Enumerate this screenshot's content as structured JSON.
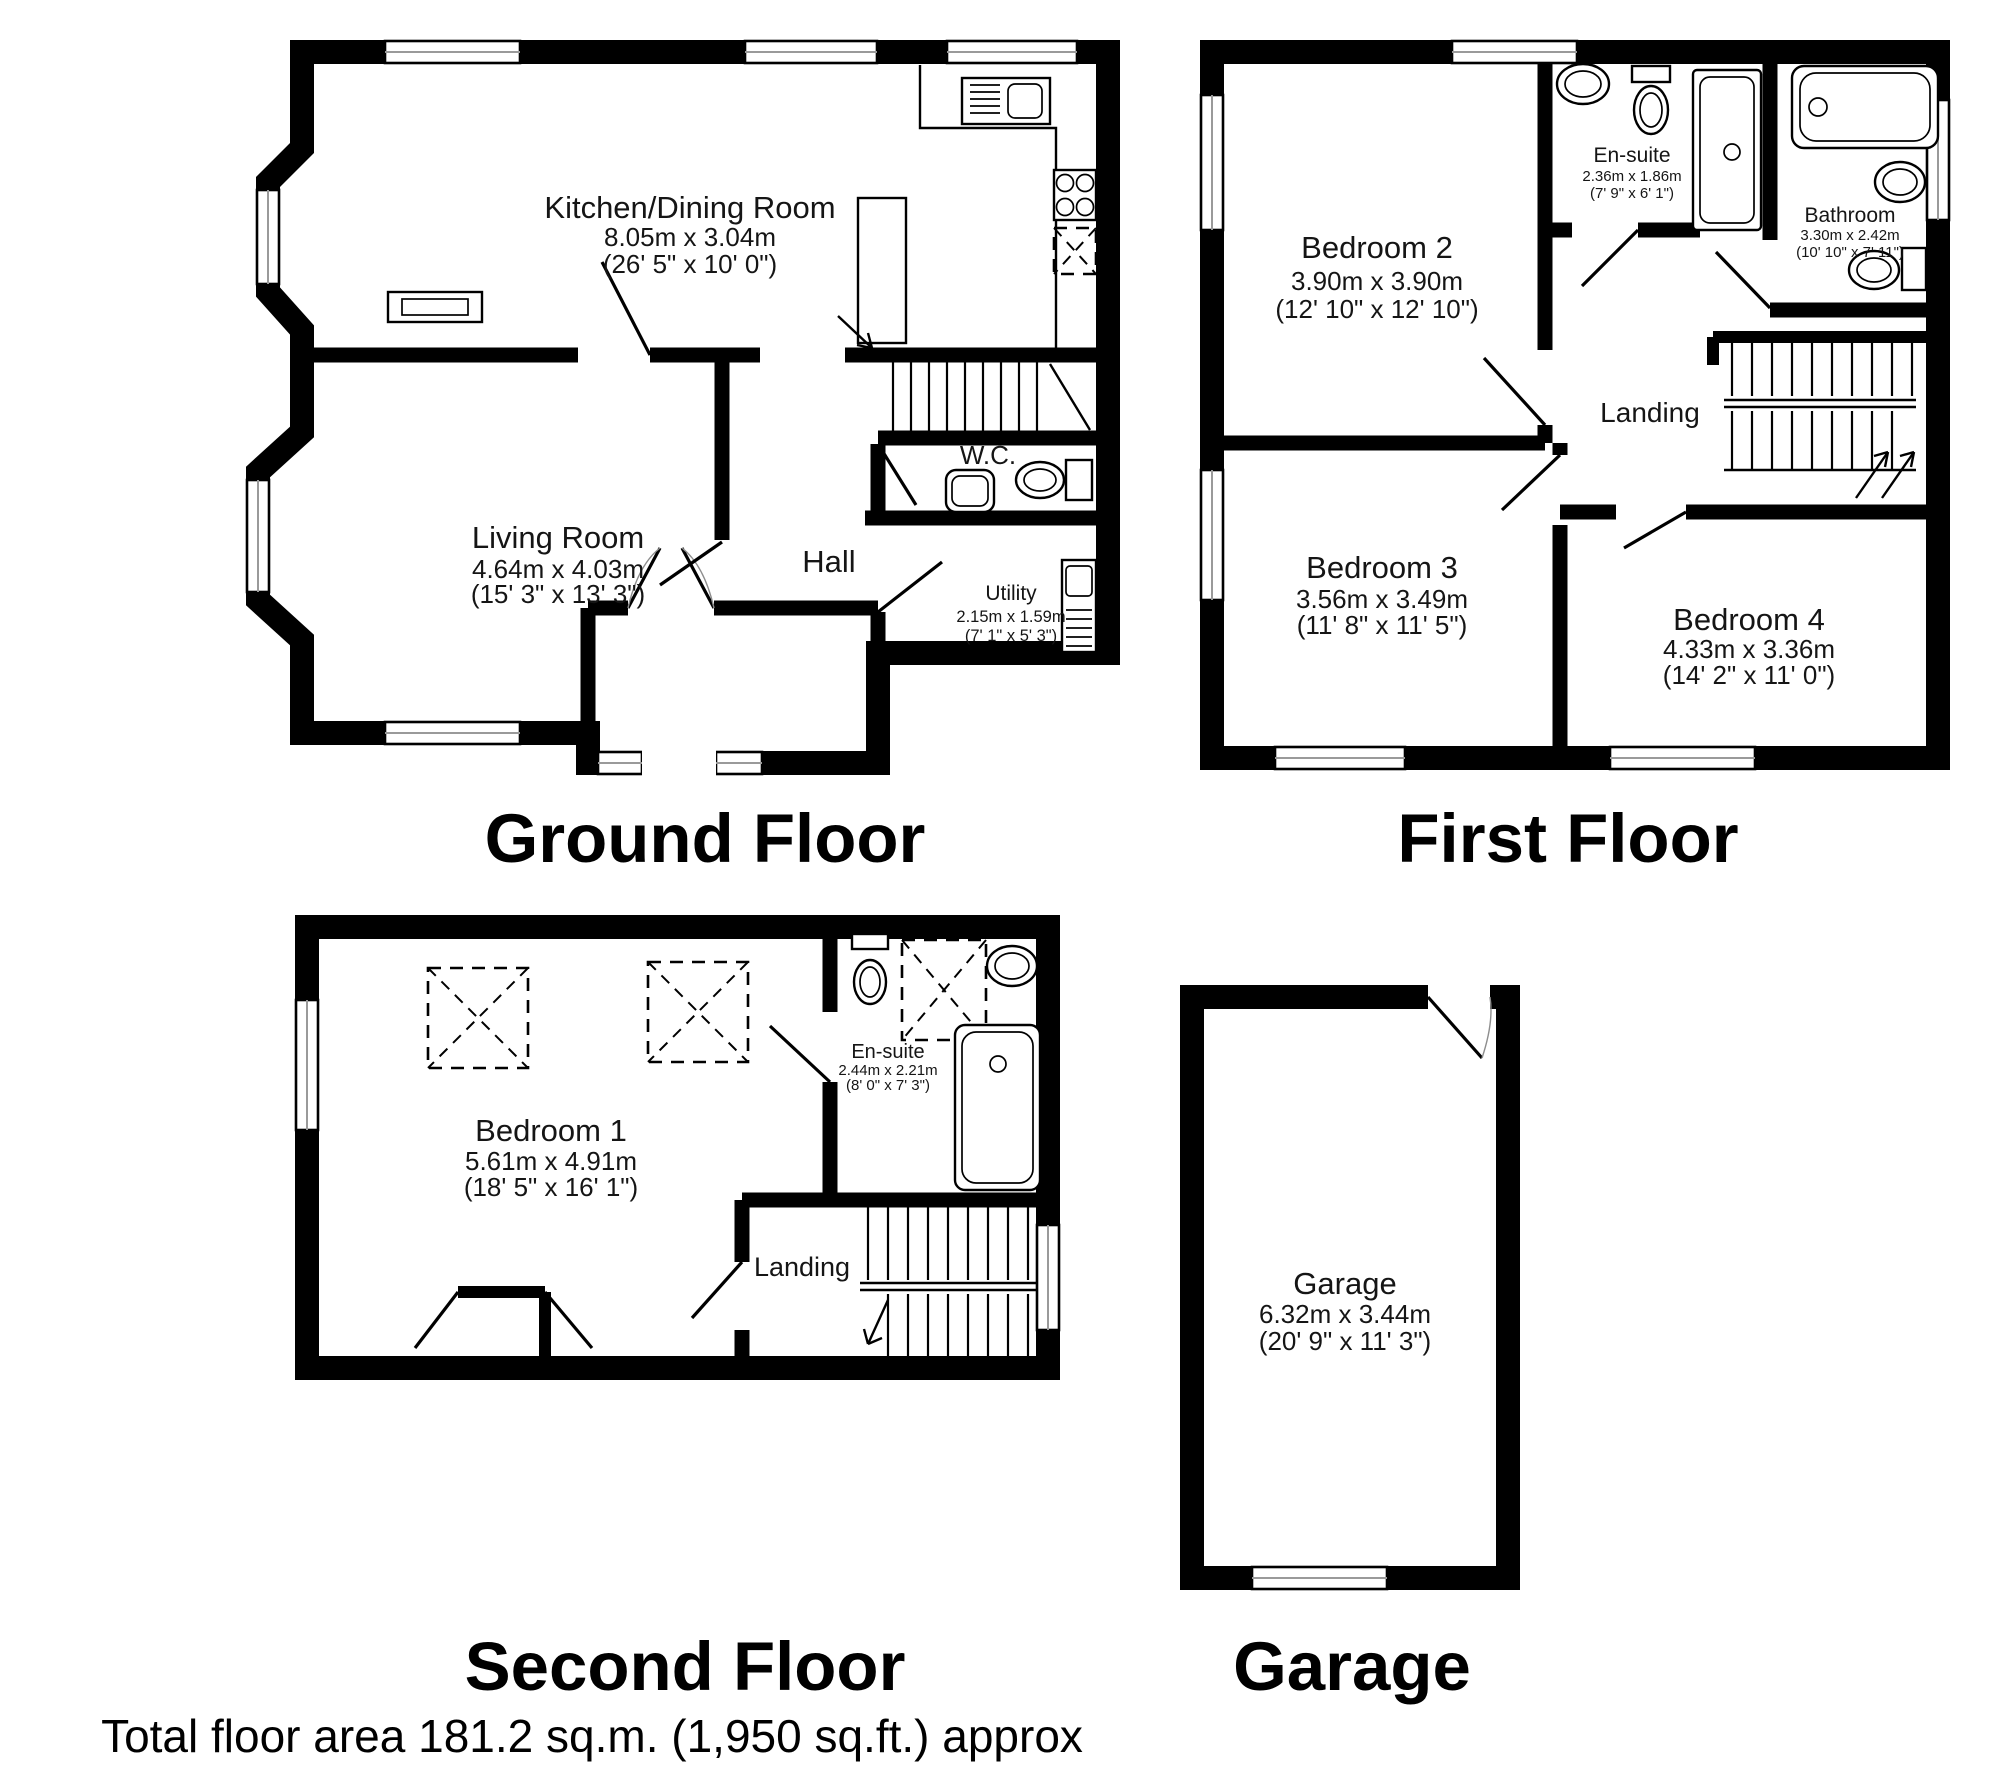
{
  "floors": {
    "ground": {
      "title": "Ground Floor",
      "rooms": {
        "kitchen": {
          "name": "Kitchen/Dining Room",
          "metric": "8.05m x 3.04m",
          "imperial": "(26' 5\" x 10' 0\")"
        },
        "living": {
          "name": "Living Room",
          "metric": "4.64m x 4.03m",
          "imperial": "(15' 3\" x 13' 3\")"
        },
        "hall": {
          "name": "Hall"
        },
        "wc": {
          "name": "W.C."
        },
        "utility": {
          "name": "Utility",
          "metric": "2.15m x 1.59m",
          "imperial": "(7' 1\" x 5' 3\")"
        }
      }
    },
    "first": {
      "title": "First Floor",
      "rooms": {
        "bedroom2": {
          "name": "Bedroom 2",
          "metric": "3.90m x 3.90m",
          "imperial": "(12' 10\" x 12' 10\")"
        },
        "ensuite": {
          "name": "En-suite",
          "metric": "2.36m x 1.86m",
          "imperial": "(7' 9\" x 6' 1\")"
        },
        "bathroom": {
          "name": "Bathroom",
          "metric": "3.30m x 2.42m",
          "imperial": "(10' 10\" x 7' 11\")"
        },
        "landing": {
          "name": "Landing"
        },
        "bedroom3": {
          "name": "Bedroom 3",
          "metric": "3.56m x 3.49m",
          "imperial": "(11' 8\" x 11' 5\")"
        },
        "bedroom4": {
          "name": "Bedroom 4",
          "metric": "4.33m x 3.36m",
          "imperial": "(14' 2\" x 11' 0\")"
        }
      }
    },
    "second": {
      "title": "Second Floor",
      "rooms": {
        "bedroom1": {
          "name": "Bedroom 1",
          "metric": "5.61m x 4.91m",
          "imperial": "(18' 5\" x 16' 1\")"
        },
        "ensuite": {
          "name": "En-suite",
          "metric": "2.44m x 2.21m",
          "imperial": "(8' 0\" x 7' 3\")"
        },
        "landing": {
          "name": "Landing"
        }
      }
    },
    "garage": {
      "title": "Garage",
      "rooms": {
        "garage": {
          "name": "Garage",
          "metric": "6.32m x 3.44m",
          "imperial": "(20' 9\" x 11' 3\")"
        }
      }
    }
  },
  "footer": {
    "total_area": "Total floor area 181.2 sq.m. (1,950 sq.ft.) approx"
  },
  "colors": {
    "wall": "#000000",
    "background": "#ffffff",
    "text": "#151515",
    "window_line": "#9a9a9a"
  }
}
